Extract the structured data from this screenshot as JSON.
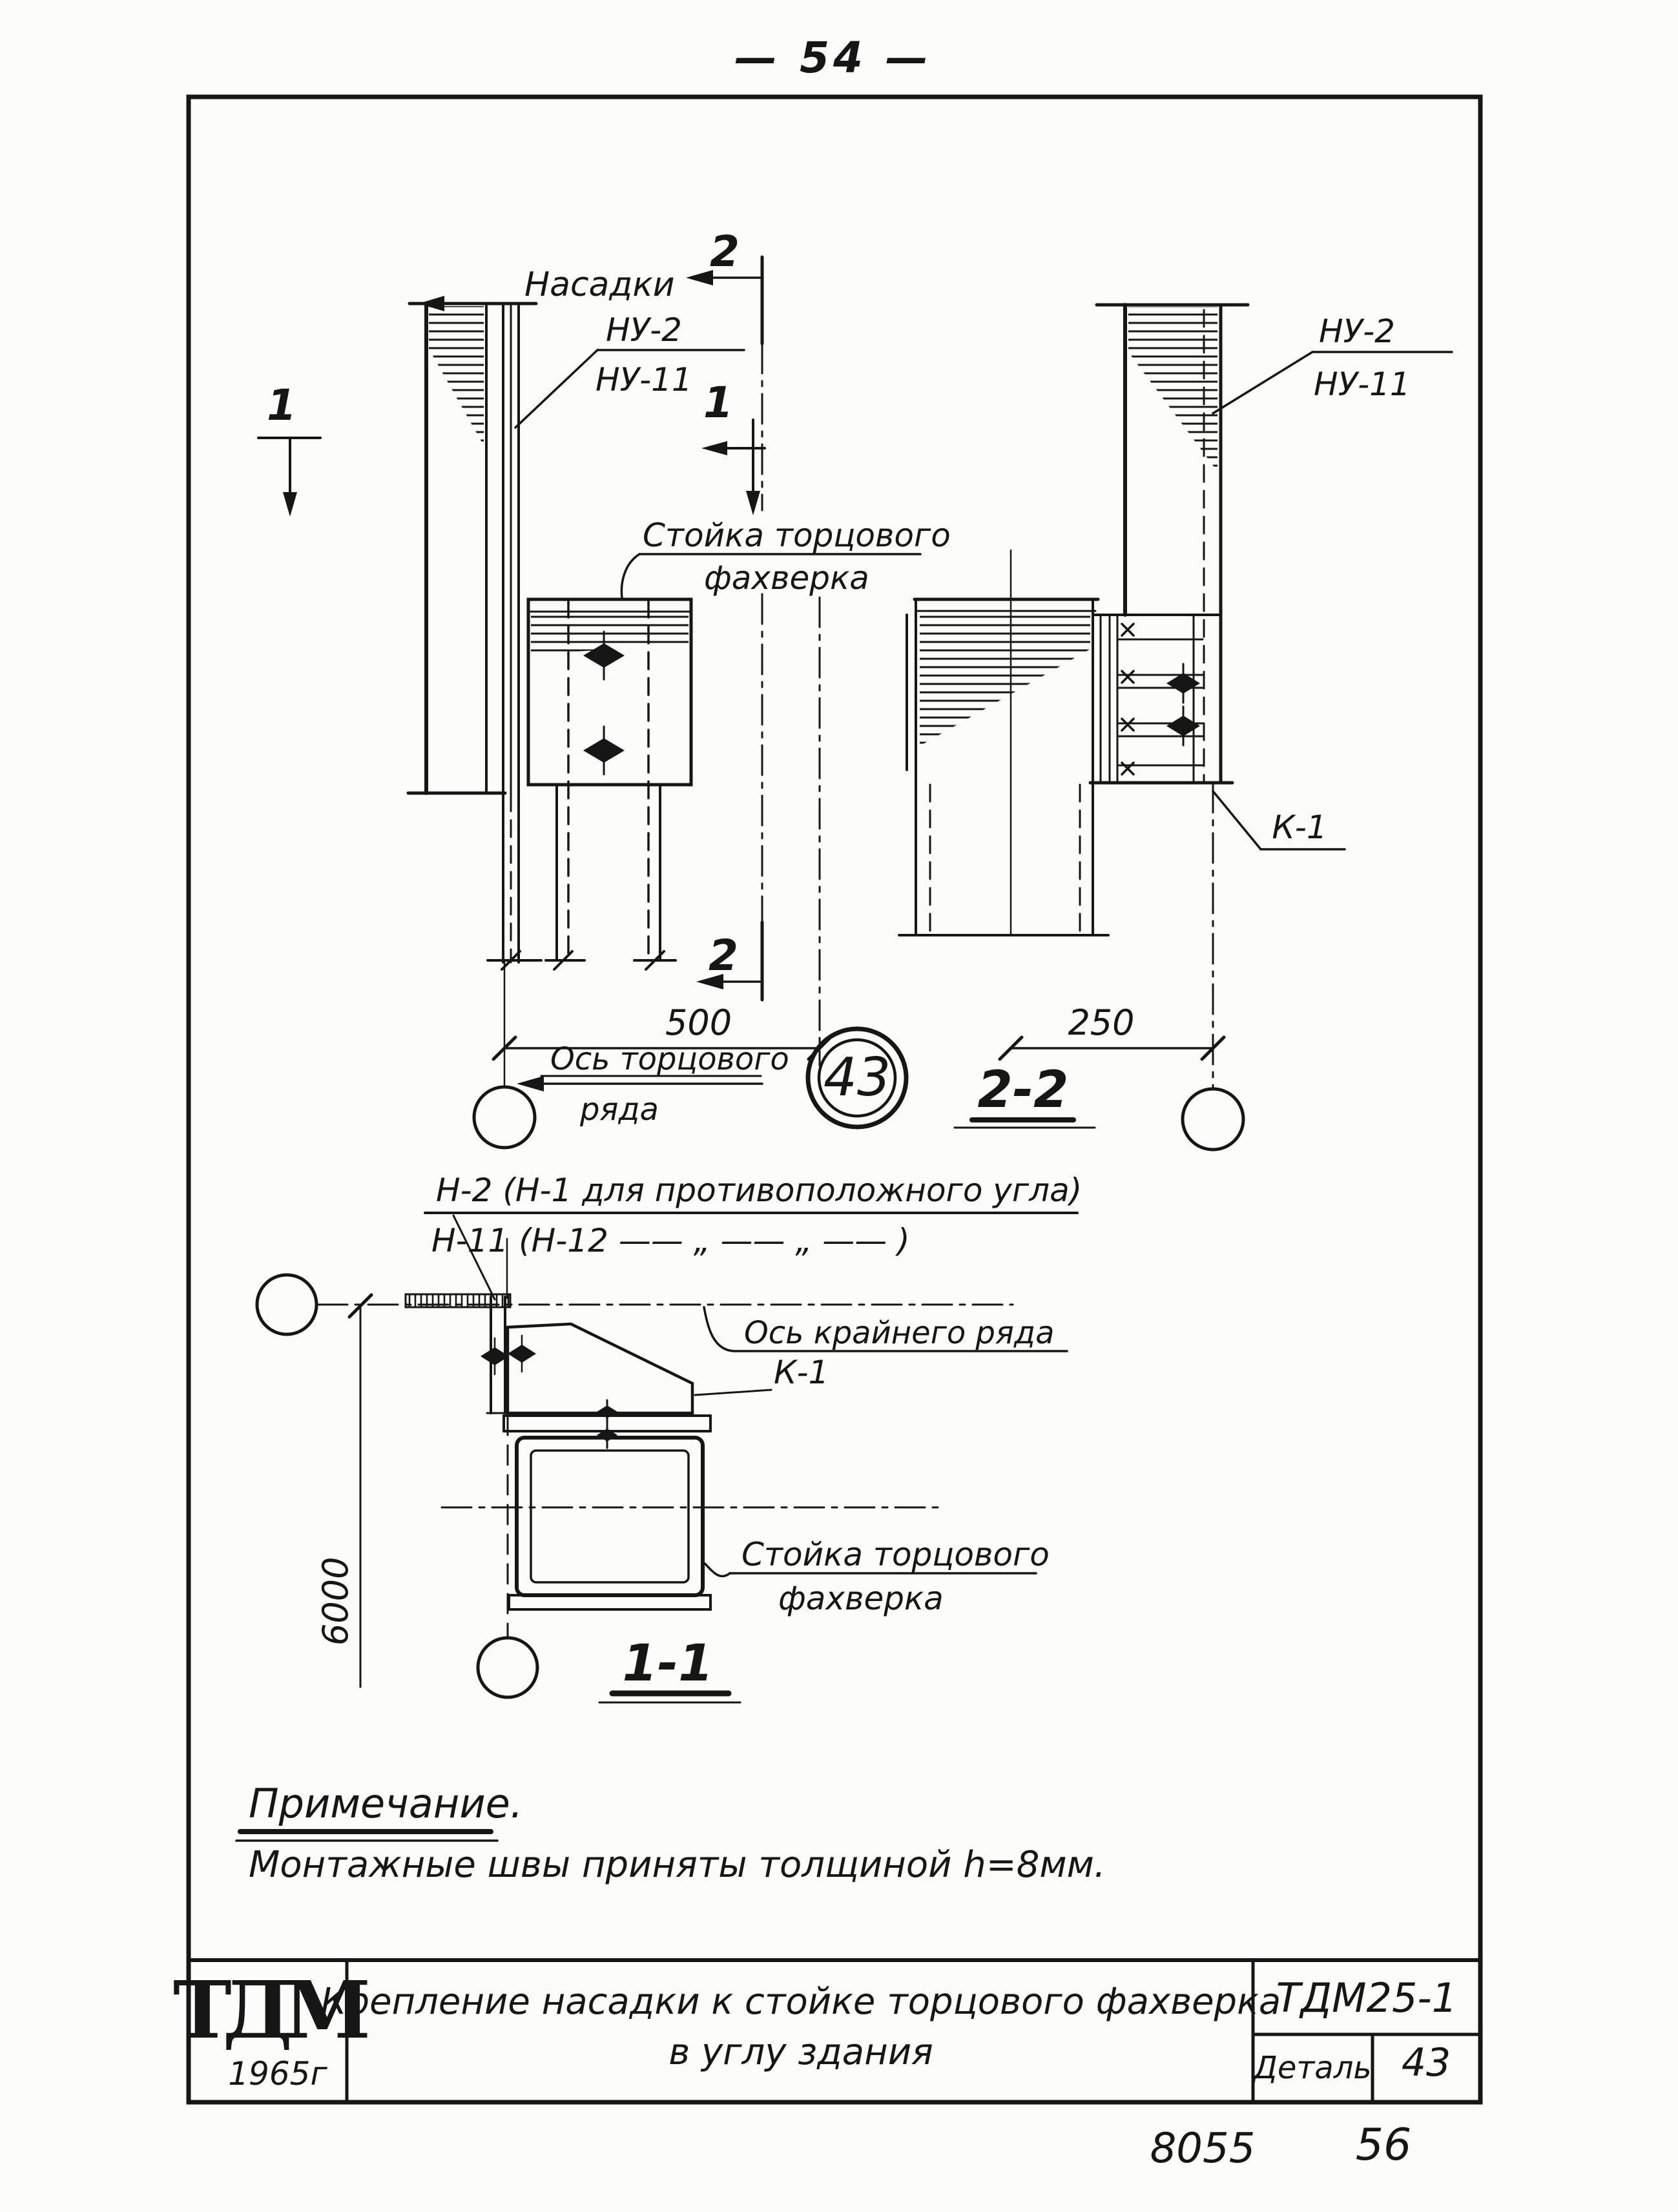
{
  "page": {
    "top_page_number": "— 54 —",
    "bottom_left_number": "8055",
    "bottom_right_number": "56",
    "ink_color": "#161616",
    "paper_color": "#fcfcfa"
  },
  "upper_left_view": {
    "nasadki_label": "Насадки",
    "nu2_label": "НУ-2",
    "nu11_label": "НУ-11",
    "stoyka_label_line1": "Стойка торцового",
    "stoyka_label_line2": "фахверка",
    "dim_500": "500",
    "axis_label_line1": "Ось торцового",
    "axis_label_line2": "ряда",
    "detail_bubble_number": "43"
  },
  "upper_right_view": {
    "nu2_label": "НУ-2",
    "nu11_label": "НУ-11",
    "k1_label": "К-1",
    "dim_250": "250",
    "section_title": "2-2"
  },
  "lower_view": {
    "note_line1": "Н-2 (Н-1 для противоположного угла)",
    "note_line2": "Н-11 (Н-12  ——  „  ——  „  —— )",
    "axis_label": "Ось крайнего ряда",
    "k1_label": "К-1",
    "dim_6000": "6000",
    "stoyka_label_line1": "Стойка торцового",
    "stoyka_label_line2": "фахверка",
    "section_title": "1-1"
  },
  "section_marks": {
    "mark_1": "1",
    "mark_2": "2"
  },
  "notes": {
    "heading": "Примечание.",
    "body": "Монтажные швы приняты толщиной h=8мм."
  },
  "title_block": {
    "logo": "ТДМ",
    "logo_year": "1965г",
    "title_line1": "Крепление насадки к стойке торцового фахверка",
    "title_line2": "в углу здания",
    "doc_code": "ТДМ25-1",
    "detail_label": "Деталь",
    "detail_number": "43"
  }
}
